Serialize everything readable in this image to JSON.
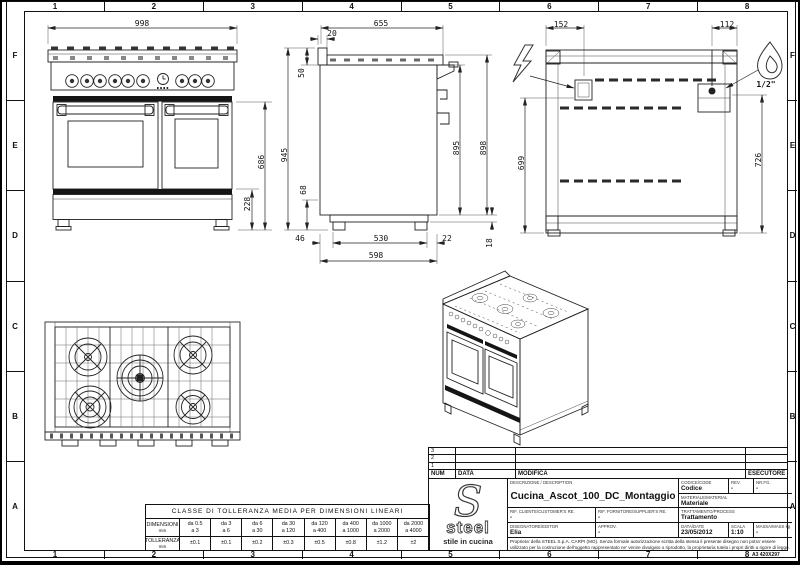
{
  "sheet": {
    "format_note": "A3 420X297",
    "grid_columns": [
      "1",
      "2",
      "3",
      "4",
      "5",
      "6",
      "7",
      "8"
    ],
    "grid_rows": [
      "F",
      "E",
      "D",
      "C",
      "B",
      "A"
    ]
  },
  "dimensions": {
    "front": {
      "width": "998",
      "door_height": "686",
      "base_height": "228"
    },
    "side": {
      "depth": "655",
      "rear_offset": "20",
      "top_height": "50",
      "total_height": "945",
      "plinth_height": "68",
      "body_height": "895",
      "rear_height": "898",
      "front_foot": "46",
      "feet_span": "530",
      "rear_foot": "22",
      "body_depth": "598",
      "bottom_gap": "18"
    },
    "rear": {
      "elec_offset": "152",
      "gas_offset": "112",
      "elec_height": "699",
      "gas_height": "726",
      "gas_connection": "1/2\""
    }
  },
  "revision_table": {
    "rows": [
      "3",
      "2",
      "1"
    ],
    "headers": {
      "num": "NUM",
      "data": "DATA",
      "modifica": "MODIFICA",
      "esecutore": "ESECUTORE"
    }
  },
  "title_block": {
    "descrizione_label": "DESCRIZIONE / DESCRIPTION",
    "descrizione": "Cucina_Ascot_100_DC_Montaggio",
    "codice_label": "CODICE/CODE",
    "codice": "Codice",
    "rev_label": "REV.",
    "rev": "-",
    "nrfg_label": "NR.FG.",
    "nrfg": "-",
    "materiale_label": "MATERIALE/MATERIAL",
    "materiale": "Materiale",
    "rif_cliente_label": "RIF. CLIENTE/CUSTOMER'S RE.",
    "rif_cliente": "-",
    "rif_fornitore_label": "RIF. FORNITORE/SUPPLIER'S RE.",
    "rif_fornitore": "-",
    "trattamento_label": "TRATTAMENTO/PROCESS",
    "trattamento": "Trattamento",
    "disegnatore_label": "DISEGNATORE/EDITOR",
    "disegnatore": "Elia",
    "approv_label": "APPROV.",
    "approv": "-",
    "data_label": "DATA/DATE",
    "data": "23/05/2012",
    "scala_label": "SCALA",
    "scala": "1:10",
    "massa_label": "MASSA/MASS kg",
    "massa": "-",
    "disclaimer": "Proprieta' della STEEL S.p.A. CARPI (MO). Senza formale autorizzazione scritta della stessa il presente disegno non potra' essere utilizzato per la costruzione dell'oggetto rappresentato ne' venire divulgato o riprodotto, la proprietaria tutela i propri diritti a rigore di legge."
  },
  "logo": {
    "brand": "steel",
    "tagline": "stile in cucina"
  },
  "tolerance_table": {
    "title": "CLASSE DI TOLLERANZA MEDIA PER DIMENSIONI LINEARI",
    "dim_label": "DIMENSIONI",
    "tol_label": "TOLLERANZA",
    "unit": "mm",
    "columns": [
      {
        "from": "da 0.5",
        "to": "a 3",
        "tol": "±0.1"
      },
      {
        "from": "da 3",
        "to": "a 6",
        "tol": "±0.1"
      },
      {
        "from": "da 6",
        "to": "a 30",
        "tol": "±0.2"
      },
      {
        "from": "da 30",
        "to": "a 120",
        "tol": "±0.3"
      },
      {
        "from": "da 120",
        "to": "a 400",
        "tol": "±0.5"
      },
      {
        "from": "da 400",
        "to": "a 1000",
        "tol": "±0.8"
      },
      {
        "from": "da 1000",
        "to": "a 2000",
        "tol": "±1.2"
      },
      {
        "from": "da 2000",
        "to": "a 4000",
        "tol": "±2"
      }
    ]
  }
}
